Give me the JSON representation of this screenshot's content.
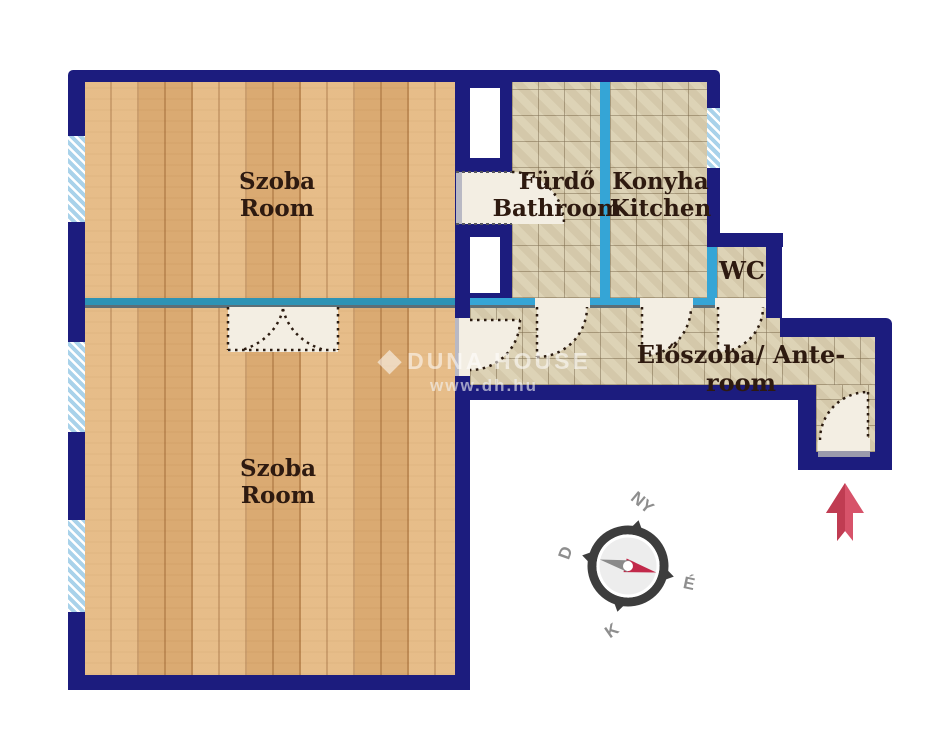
{
  "plan": {
    "rooms": {
      "room1": {
        "hu": "Szoba",
        "en": "Room"
      },
      "room2": {
        "hu": "Szoba",
        "en": "Room"
      },
      "bathroom": {
        "hu": "Fürdő",
        "en": "Bathroom"
      },
      "kitchen": {
        "hu": "Konyha",
        "en": "Kitchen"
      },
      "wc": {
        "label": "WC"
      },
      "hall": {
        "label": "Előszoba/ Ante-room"
      }
    },
    "compass": {
      "north": "É",
      "south": "D",
      "east": "K",
      "west": "NY"
    },
    "watermark": {
      "logo_icon": "diamond-logo-icon",
      "brand": "DUNA HOUSE",
      "url": "www.dh.hu"
    },
    "colors": {
      "load_bearing_wall": "#1c1c7e",
      "partition_wall": "#35a5d6",
      "room_divider": "#2e93b5",
      "wood_floor": "#e2b47c",
      "tile_floor": "#dbd0b2",
      "window_glass": "#a9d2ea",
      "door_leaf": "#f3eee3",
      "entrance_arrow": "#d7536a",
      "compass_needle_red": "#c2294a",
      "compass_ring": "#3d3d3d",
      "label_text": "#2e1a10"
    }
  }
}
